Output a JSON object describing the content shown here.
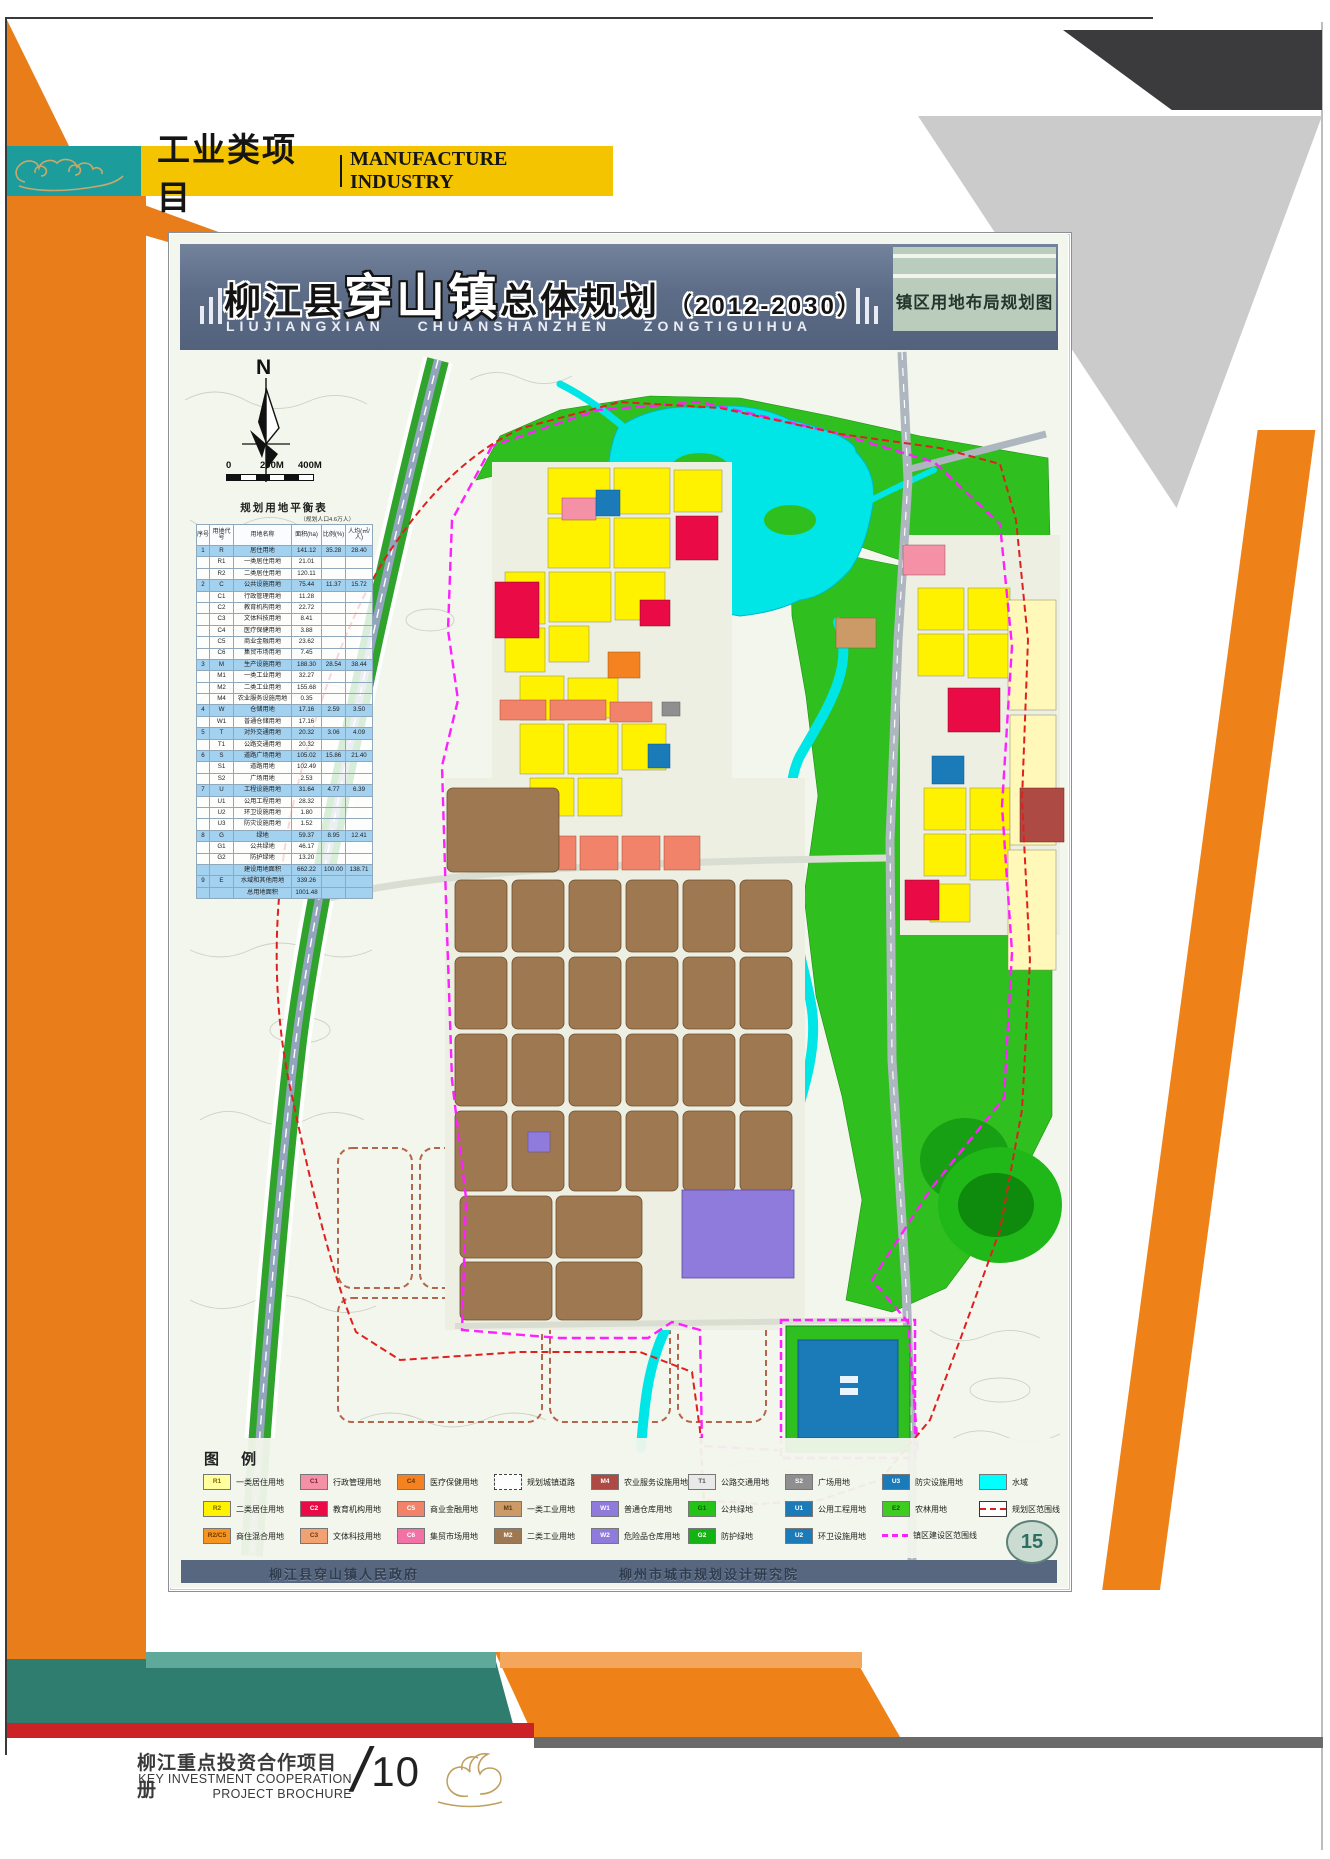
{
  "header": {
    "title_cn": "工业类项目",
    "title_en": "MANUFACTURE INDUSTRY"
  },
  "map_title": {
    "prefix": "柳江县",
    "highlight": "穿山镇",
    "suffix": "总体规划",
    "period": "（2012-2030）",
    "romanized": "LIUJIANGXIAN CHUANSHANZHEN ZONGTIGUIHUA",
    "side_label": "镇区用地布局规划图"
  },
  "compass": {
    "north": "N"
  },
  "scalebar": {
    "labels": [
      "0",
      "200M",
      "400M"
    ]
  },
  "balance_table": {
    "title": "规划用地平衡表",
    "note": "（规划人口4.6万人）",
    "headers": [
      "序号",
      "用地代号",
      "用地名称",
      "面积(ha)",
      "比例(%)",
      "人均(㎡/人)"
    ],
    "rows": [
      [
        "1",
        "R",
        "居住用地",
        "141.12",
        "35.28",
        "28.40",
        true
      ],
      [
        "",
        "R1",
        "一类居住用地",
        "21.01",
        "",
        "",
        false
      ],
      [
        "",
        "R2",
        "二类居住用地",
        "120.11",
        "",
        "",
        false
      ],
      [
        "2",
        "C",
        "公共设施用地",
        "75.44",
        "11.37",
        "15.72",
        true
      ],
      [
        "",
        "C1",
        "行政管理用地",
        "11.28",
        "",
        "",
        false
      ],
      [
        "",
        "C2",
        "教育机构用地",
        "22.72",
        "",
        "",
        false
      ],
      [
        "",
        "C3",
        "文体科技用地",
        "8.41",
        "",
        "",
        false
      ],
      [
        "",
        "C4",
        "医疗保健用地",
        "3.88",
        "",
        "",
        false
      ],
      [
        "",
        "C5",
        "商业金融用地",
        "23.62",
        "",
        "",
        false
      ],
      [
        "",
        "C6",
        "集贸市场用地",
        "7.45",
        "",
        "",
        false
      ],
      [
        "3",
        "M",
        "生产设施用地",
        "188.30",
        "28.54",
        "38.44",
        true
      ],
      [
        "",
        "M1",
        "一类工业用地",
        "32.27",
        "",
        "",
        false
      ],
      [
        "",
        "M2",
        "二类工业用地",
        "155.68",
        "",
        "",
        false
      ],
      [
        "",
        "M4",
        "农业服务设施用地",
        "0.35",
        "",
        "",
        false
      ],
      [
        "4",
        "W",
        "仓储用地",
        "17.16",
        "2.59",
        "3.50",
        true
      ],
      [
        "",
        "W1",
        "普通仓储用地",
        "17.16",
        "",
        "",
        false
      ],
      [
        "5",
        "T",
        "对外交通用地",
        "20.32",
        "3.06",
        "4.09",
        true
      ],
      [
        "",
        "T1",
        "公路交通用地",
        "20.32",
        "",
        "",
        false
      ],
      [
        "6",
        "S",
        "道路广场用地",
        "105.02",
        "15.86",
        "21.40",
        true
      ],
      [
        "",
        "S1",
        "道路用地",
        "102.49",
        "",
        "",
        false
      ],
      [
        "",
        "S2",
        "广场用地",
        "2.53",
        "",
        "",
        false
      ],
      [
        "7",
        "U",
        "工程设施用地",
        "31.64",
        "4.77",
        "6.39",
        true
      ],
      [
        "",
        "U1",
        "公用工程用地",
        "28.32",
        "",
        "",
        false
      ],
      [
        "",
        "U2",
        "环卫设施用地",
        "1.80",
        "",
        "",
        false
      ],
      [
        "",
        "U3",
        "防灾设施用地",
        "1.52",
        "",
        "",
        false
      ],
      [
        "8",
        "G",
        "绿地",
        "59.37",
        "8.95",
        "12.41",
        true
      ],
      [
        "",
        "G1",
        "公共绿地",
        "46.17",
        "",
        "",
        false
      ],
      [
        "",
        "G2",
        "防护绿地",
        "13.20",
        "",
        "",
        false
      ],
      [
        "",
        "",
        "建设用地面积",
        "662.22",
        "100.00",
        "138.71",
        true
      ],
      [
        "9",
        "E",
        "水域和其他用地",
        "339.26",
        "",
        "",
        true
      ],
      [
        "",
        "",
        "总用地面积",
        "1001.48",
        "",
        "",
        true
      ]
    ]
  },
  "legend": {
    "title": "图 例",
    "rows": [
      [
        {
          "code": "R1",
          "color": "#FFFF9E",
          "tc": "#7A6A00",
          "label": "一类居住用地"
        },
        {
          "code": "C1",
          "color": "#F491A7",
          "tc": "#7A2238",
          "label": "行政管理用地"
        },
        {
          "code": "C4",
          "color": "#F58220",
          "tc": "#6A3000",
          "label": "医疗保健用地"
        },
        {
          "type": "road",
          "label": "规划城镇道路"
        },
        {
          "code": "M4",
          "color": "#AE4A44",
          "tc": "#FFFFFF",
          "label": "农业服务设施用地"
        },
        {
          "code": "T1",
          "color": "#E9E9E9",
          "tc": "#555555",
          "label": "公路交通用地"
        },
        {
          "code": "S2",
          "color": "#8F8F8F",
          "tc": "#FFFFFF",
          "label": "广场用地"
        },
        {
          "code": "U3",
          "color": "#1B7AB8",
          "tc": "#FFFFFF",
          "label": "防灾设施用地"
        },
        {
          "type": "water",
          "color": "#00FFFF",
          "label": "水域"
        }
      ],
      [
        {
          "code": "R2",
          "color": "#FFF200",
          "tc": "#7A6A00",
          "label": "二类居住用地"
        },
        {
          "code": "C2",
          "color": "#EA0A45",
          "tc": "#FFFFFF",
          "label": "教育机构用地"
        },
        {
          "code": "C5",
          "color": "#F2836B",
          "tc": "#FFFFFF",
          "label": "商业金融用地"
        },
        {
          "code": "M1",
          "color": "#CC9A66",
          "tc": "#5A3A10",
          "label": "一类工业用地"
        },
        {
          "code": "W1",
          "color": "#8F7BDB",
          "tc": "#FFFFFF",
          "label": "普通仓库用地"
        },
        {
          "code": "G1",
          "color": "#23C417",
          "tc": "#0A5A00",
          "label": "公共绿地"
        },
        {
          "code": "U1",
          "color": "#1B7AB8",
          "tc": "#FFFFFF",
          "label": "公用工程用地"
        },
        {
          "code": "E2",
          "color": "#3ECC1F",
          "tc": "#0A5A00",
          "label": "农林用地"
        },
        {
          "type": "line-red",
          "label": "规划区范围线"
        }
      ],
      [
        {
          "code": "R2/C5",
          "color": "#F7941D",
          "tc": "#6A3A00",
          "label": "商住混合用地"
        },
        {
          "code": "C3",
          "color": "#F2A173",
          "tc": "#6A3A10",
          "label": "文体科技用地"
        },
        {
          "code": "C6",
          "color": "#F272A5",
          "tc": "#FFFFFF",
          "label": "集贸市场用地"
        },
        {
          "code": "M2",
          "color": "#9E7850",
          "tc": "#FFFFFF",
          "label": "二类工业用地"
        },
        {
          "code": "W2",
          "color": "#8F7BDB",
          "tc": "#FFFFFF",
          "label": "危险品仓库用地"
        },
        {
          "code": "G2",
          "color": "#12B312",
          "tc": "#FFFFFF",
          "label": "防护绿地"
        },
        {
          "code": "U2",
          "color": "#1B7AB8",
          "tc": "#FFFFFF",
          "label": "环卫设施用地"
        },
        {
          "type": "line-mag",
          "label": "镇区建设区范围线"
        }
      ]
    ]
  },
  "sheet_footer": {
    "left_org": "柳江县穿山镇人民政府",
    "right_org": "柳州市城市规划设计研究院"
  },
  "page_badge": "15",
  "brochure_footer": {
    "title_cn": "柳江重点投资合作项目册",
    "title_en_line1": "KEY INVESTMENT COOPERATION",
    "title_en_line2": "PROJECT BROCHURE",
    "slash": "/",
    "page_number": "10"
  },
  "colors": {
    "banner_yellow": "#F5C400",
    "teal": "#1D9C9C",
    "teal_dark": "#2E7D6E",
    "orange": "#E87D1A",
    "red_strip": "#CC2127",
    "titlebar_blue": "#5D6C87",
    "side_panel_green": "#BACDBC",
    "water_cyan": "#00FFFF",
    "boundary_red": "#E02020",
    "boundary_magenta": "#FF20FF"
  }
}
